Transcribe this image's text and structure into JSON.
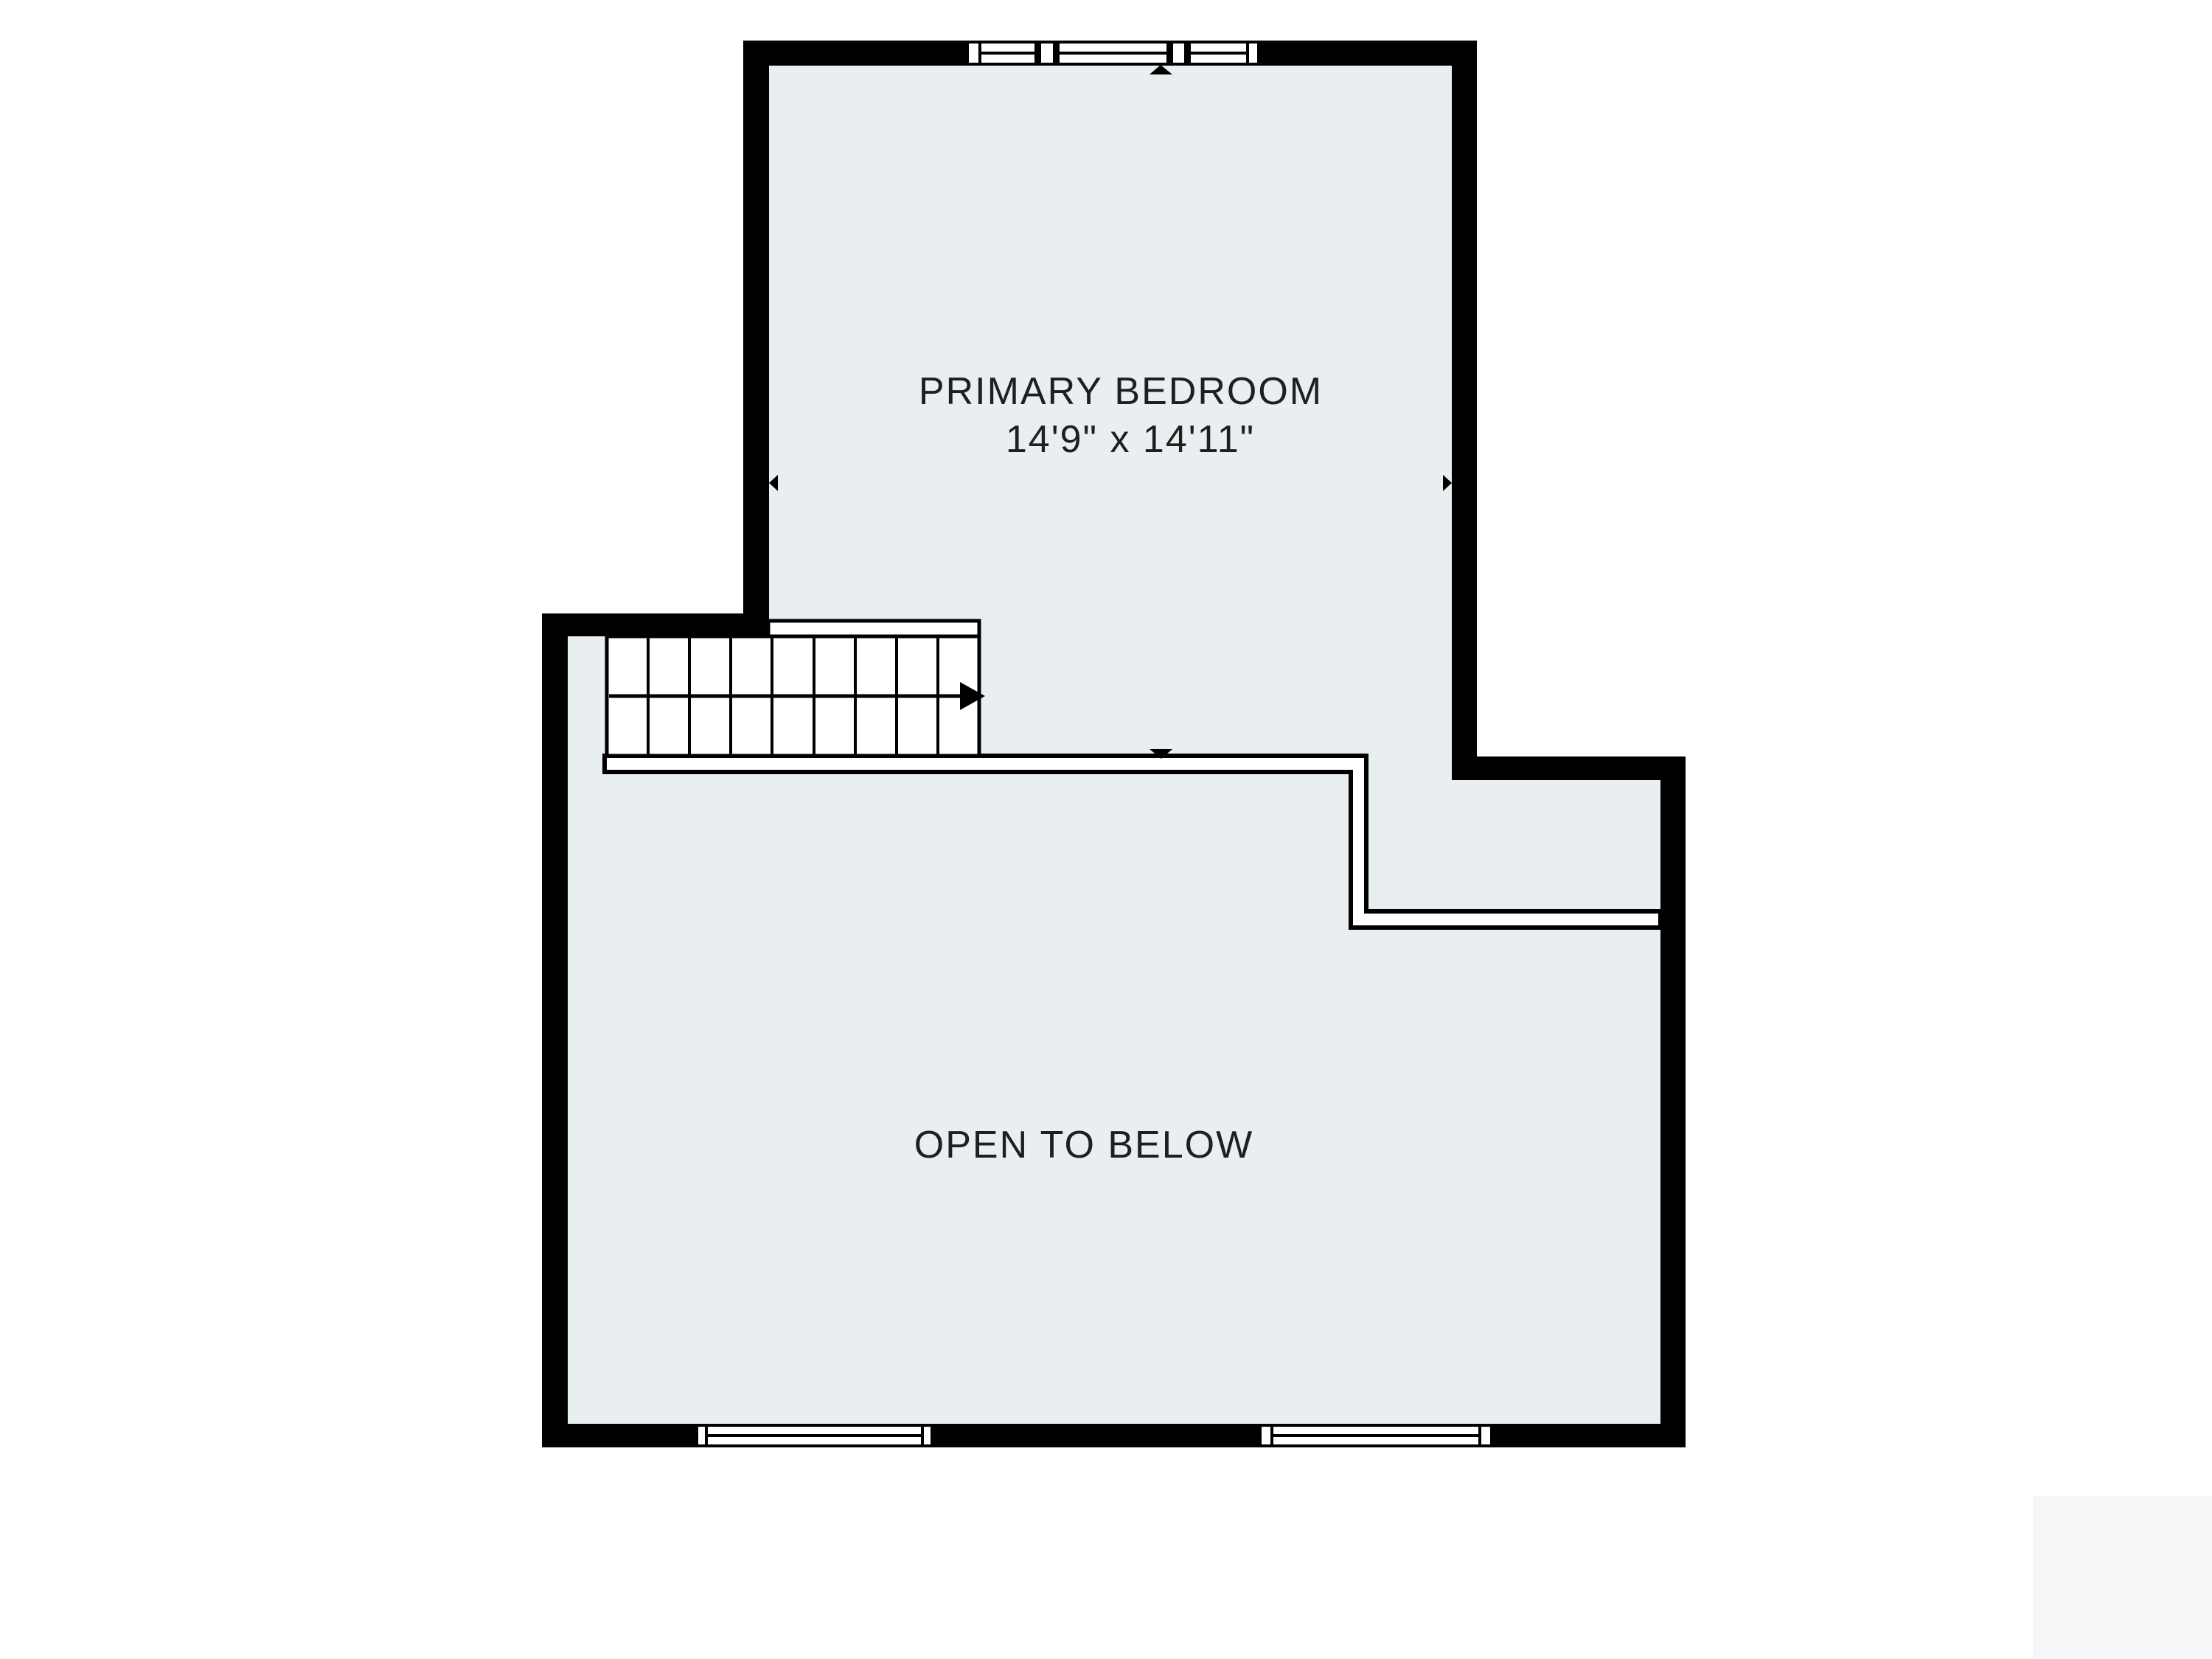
{
  "title": "Upper floor plan",
  "colors": {
    "background": "#ffffff",
    "paper": "#ffffff",
    "floor": "#e9eef1",
    "wall": "#000000",
    "text": "#1f1f1f",
    "watermark": "#f5f7f8"
  },
  "rooms": {
    "primary_bedroom": {
      "name": "PRIMARY BEDROOM",
      "dimensions": "14'9\" x 14'11\""
    },
    "open_to_below": {
      "name": "OPEN TO BELOW"
    }
  },
  "stairs": {
    "tread_count": 9,
    "direction": "right"
  },
  "windows": {
    "top_wall": 1,
    "bottom_wall": 2
  }
}
